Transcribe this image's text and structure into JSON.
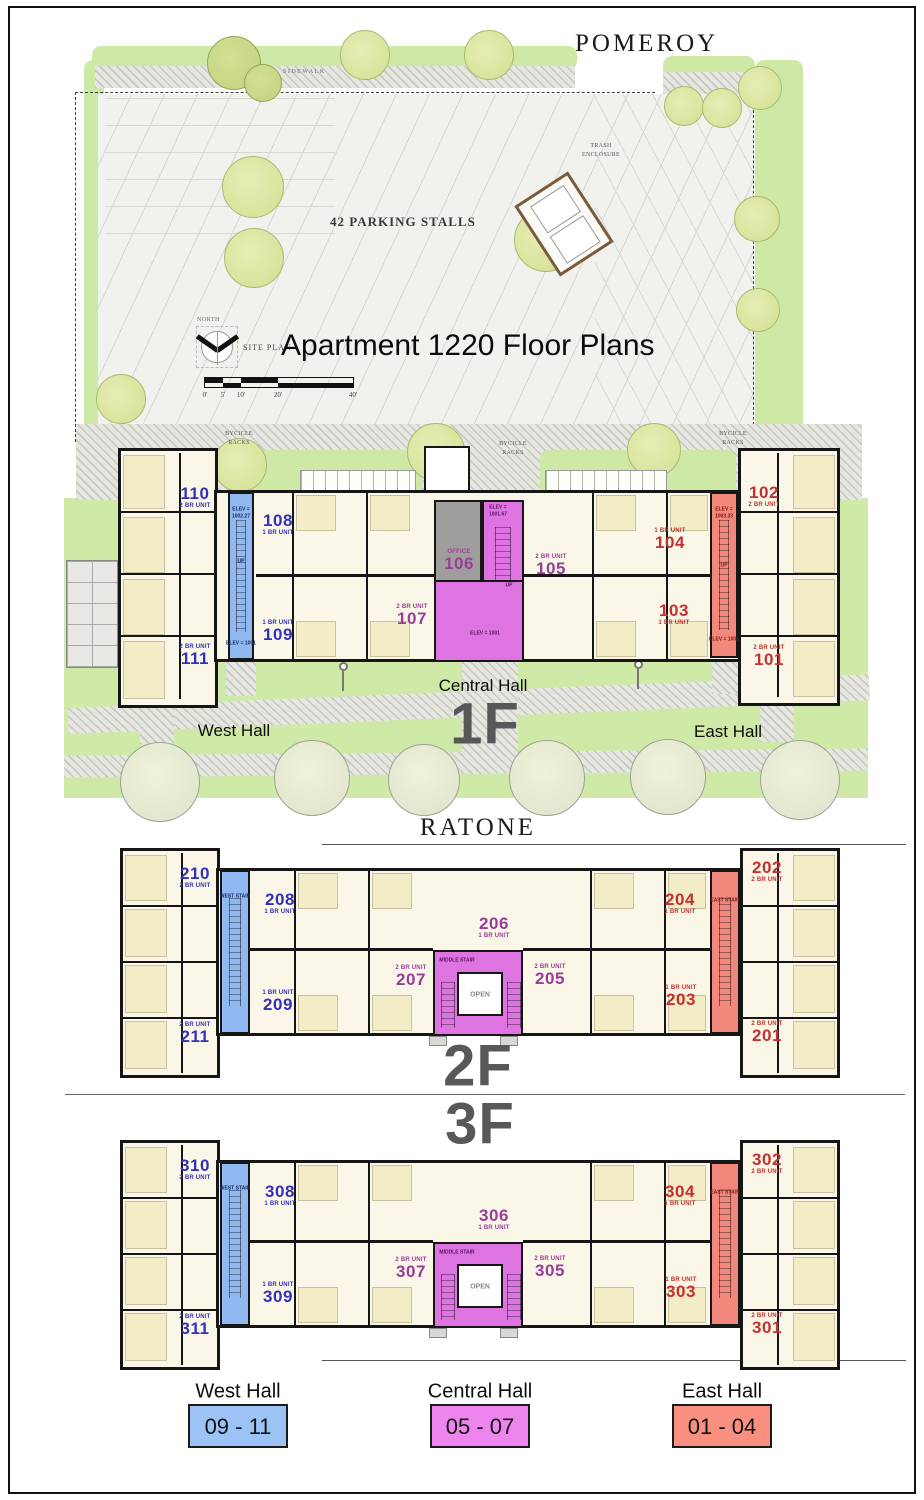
{
  "streets": {
    "pomeroy": "POMEROY",
    "ratone": "RATONE"
  },
  "site": {
    "north": "NORTH",
    "site_plan": "SITE PLAN",
    "title": "Apartment 1220 Floor Plans",
    "parking": "42 PARKING STALLS",
    "trash": "TRASH\nENCLOSURE",
    "sidewalk": "SIDEWALK",
    "bike_racks": "BYCICLE\nRACKS",
    "scale": [
      "0'",
      "5'",
      "10'",
      "20'",
      "40'"
    ]
  },
  "halls": {
    "west": "West Hall",
    "central": "Central Hall",
    "east": "East Hall"
  },
  "floors": {
    "f1": {
      "big": "1F",
      "stairs": {
        "west_top": "ELEV =\n1002.27",
        "west_up": "UP",
        "west_bot": "ELEV = 1001",
        "mid_top": "ELEV =\n1001.67",
        "mid_up": "UP",
        "mid_bot": "ELEV = 1001",
        "east_top": "ELEV =\n1003.33",
        "east_up": "UP",
        "east_bot": "ELEV = 1001"
      },
      "units": {
        "u110": {
          "n": "110",
          "t": "2 BR UNIT"
        },
        "u108": {
          "n": "108",
          "t": "1 BR UNIT"
        },
        "u109": {
          "n": "109",
          "t": "1 BR UNIT"
        },
        "u111": {
          "n": "111",
          "t": "2 BR UNIT"
        },
        "u106": {
          "n": "106",
          "t": "OFFICE"
        },
        "u107": {
          "n": "107",
          "t": "2 BR UNIT"
        },
        "u105": {
          "n": "105",
          "t": "2 BR UNIT"
        },
        "u104": {
          "n": "104",
          "t": "1 BR UNIT"
        },
        "u103": {
          "n": "103",
          "t": "1 BR UNIT"
        },
        "u102": {
          "n": "102",
          "t": "2 BR UNIT"
        },
        "u101": {
          "n": "101",
          "t": "2 BR UNIT"
        }
      }
    },
    "f2": {
      "big": "2F",
      "stairs": {
        "west": "WEST STAIR",
        "mid": "MIDDLE STAIR",
        "east": "EAST STAIR",
        "open": "OPEN"
      },
      "units": {
        "u210": {
          "n": "210",
          "t": "2 BR UNIT"
        },
        "u208": {
          "n": "208",
          "t": "1 BR UNIT"
        },
        "u209": {
          "n": "209",
          "t": "1 BR UNIT"
        },
        "u211": {
          "n": "211",
          "t": "2 BR UNIT"
        },
        "u206": {
          "n": "206",
          "t": "1 BR UNIT"
        },
        "u207": {
          "n": "207",
          "t": "2 BR UNIT"
        },
        "u205": {
          "n": "205",
          "t": "2 BR UNIT"
        },
        "u204": {
          "n": "204",
          "t": "1 BR UNIT"
        },
        "u203": {
          "n": "203",
          "t": "1 BR UNIT"
        },
        "u202": {
          "n": "202",
          "t": "2 BR UNIT"
        },
        "u201": {
          "n": "201",
          "t": "2 BR UNIT"
        }
      }
    },
    "f3": {
      "big": "3F",
      "stairs": {
        "west": "WEST STAIR",
        "mid": "MIDDLE STAIR",
        "east": "EAST STAIR",
        "open": "OPEN"
      },
      "units": {
        "u310": {
          "n": "310",
          "t": "2 BR UNIT"
        },
        "u308": {
          "n": "308",
          "t": "1 BR UNIT"
        },
        "u309": {
          "n": "309",
          "t": "1 BR UNIT"
        },
        "u311": {
          "n": "311",
          "t": "2 BR UNIT"
        },
        "u306": {
          "n": "306",
          "t": "1 BR UNIT"
        },
        "u307": {
          "n": "307",
          "t": "2 BR UNIT"
        },
        "u305": {
          "n": "305",
          "t": "2 BR UNIT"
        },
        "u304": {
          "n": "304",
          "t": "1 BR UNIT"
        },
        "u303": {
          "n": "303",
          "t": "1 BR UNIT"
        },
        "u302": {
          "n": "302",
          "t": "2 BR UNIT"
        },
        "u301": {
          "n": "301",
          "t": "2 BR UNIT"
        }
      }
    }
  },
  "legend": {
    "west": {
      "name": "West Hall",
      "range": "09 - 11",
      "color": "#9cc3f5"
    },
    "central": {
      "name": "Central Hall",
      "range": "05 - 07",
      "color": "#ee85ee"
    },
    "east": {
      "name": "East Hall",
      "range": "01 - 04",
      "color": "#f9907f"
    }
  },
  "colors": {
    "west_stair": "#8fb9f0",
    "central_stair": "#dd74e2",
    "east_stair": "#f2877b",
    "unit_west_text": "#3232b8",
    "unit_central_text": "#993d99",
    "unit_east_text": "#c53030",
    "lawn": "#cfe9a6",
    "building": "#faf7e8"
  }
}
